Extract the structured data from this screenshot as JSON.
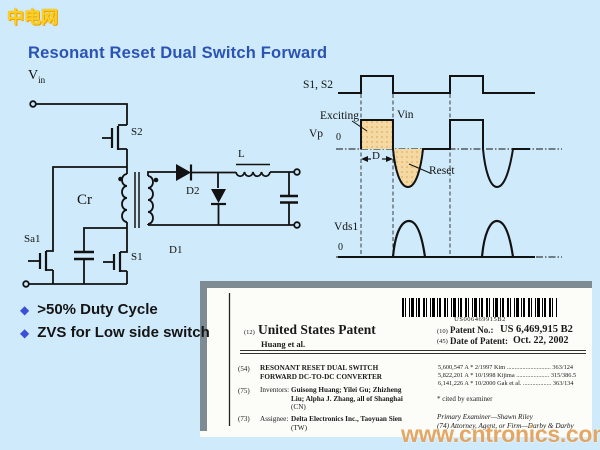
{
  "logo": {
    "text": "中电网"
  },
  "title": {
    "text": "Resonant Reset Dual Switch Forward"
  },
  "colors": {
    "background": "#cfeafb",
    "title_blue": "#2b53b5",
    "bullet_blue": "#3b4fd8",
    "waveform_fill_tan": "#f5d9a2",
    "watermark_orange": "#df9442",
    "patent_frame_gray": "#7f8b92",
    "line_black": "#121212"
  },
  "circuit": {
    "vin_main": "V",
    "vin_sub": "in",
    "s2": "S2",
    "cr": "Cr",
    "sa1": "Sa1",
    "s1": "S1",
    "d1": "D1",
    "d2": "D2",
    "l": "L"
  },
  "waveform": {
    "s1s2": "S1, S2",
    "exciting": "Exciting",
    "vin": "Vin",
    "vp": "Vp",
    "zero_top": "0",
    "duty": "D",
    "reset": "Reset",
    "vds1": "Vds1",
    "zero_bottom": "0"
  },
  "bullets": {
    "bullet_char": "◆",
    "items": [
      ">50% Duty Cycle",
      "ZVS for Low side switch"
    ]
  },
  "patent": {
    "barcode_number": "US006469915B2",
    "kind_code_label": "(12)",
    "doc_title": "United States Patent",
    "authors": "Huang et al.",
    "patent_no_code": "(10)",
    "patent_no_label": "Patent No.:",
    "patent_no_value": "US 6,469,915 B2",
    "date_code": "(45)",
    "date_label": "Date of Patent:",
    "date_value": "Oct. 22, 2002",
    "title_code": "(54)",
    "title_line1": "RESONANT RESET DUAL SWITCH",
    "title_line2": "FORWARD DC-TO-DC CONVERTER",
    "inventors_code": "(75)",
    "inventors_label": "Inventors:",
    "inventors_line1": "Guisong Huang; Yilei Gu; Zhizheng",
    "inventors_line2": "Liu; Alpha J. Zhang, all of Shanghai",
    "inventors_line3": "(CN)",
    "assignee_code": "(73)",
    "assignee_label": "Assignee:",
    "assignee_line1": "Delta Electronics Inc., Taoyuan Sien",
    "assignee_line2": "(TW)",
    "citations": [
      "5,600,547 A  *  2/1997  Kim ............................ 363/124",
      "5,822,201 A  *  10/1998  Kijima ..................... 315/386.5",
      "6,141,226 A  *  10/2000  Gak et al. .................. 363/134"
    ],
    "cited_note": "* cited by examiner",
    "examiner_line": "Primary Examiner—Shawn Riley",
    "attorney_line": "(74) Attorney, Agent, or Firm—Darby & Darby"
  },
  "watermark": {
    "text": "www.cntronics.com"
  }
}
